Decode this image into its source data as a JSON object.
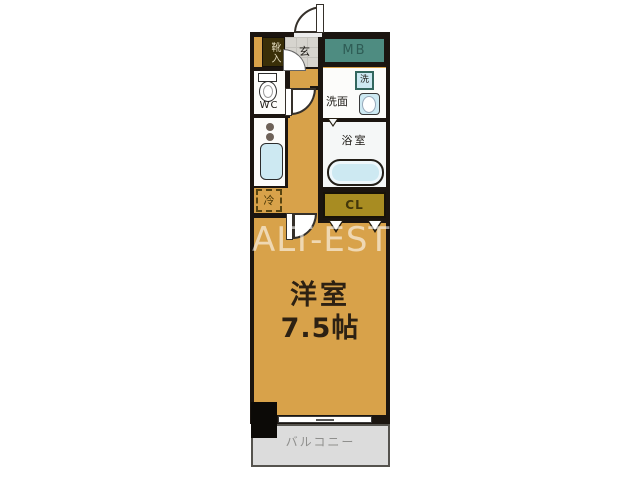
{
  "watermark": "ALT-EST",
  "plan": {
    "entrance_label": "玄",
    "shoe_label": "靴入",
    "meter_box_label": "MB",
    "wc_label": "WC",
    "washroom_label": "洗面",
    "washer_label": "洗",
    "bathroom_label": "浴室",
    "fridge_label": "冷",
    "closet_label": "CL",
    "room_label": "洋室",
    "room_size_label": "7.5帖",
    "balcony_label": "バルコニー"
  },
  "colors": {
    "floor_tan": "#d8a24a",
    "meter_box_teal": "#4e8c81",
    "closet_olive": "#a88c22",
    "wall_dark": "#1b1510",
    "fixture_blue": "#cde9f2",
    "balcony_gray": "#dcdcdc"
  }
}
